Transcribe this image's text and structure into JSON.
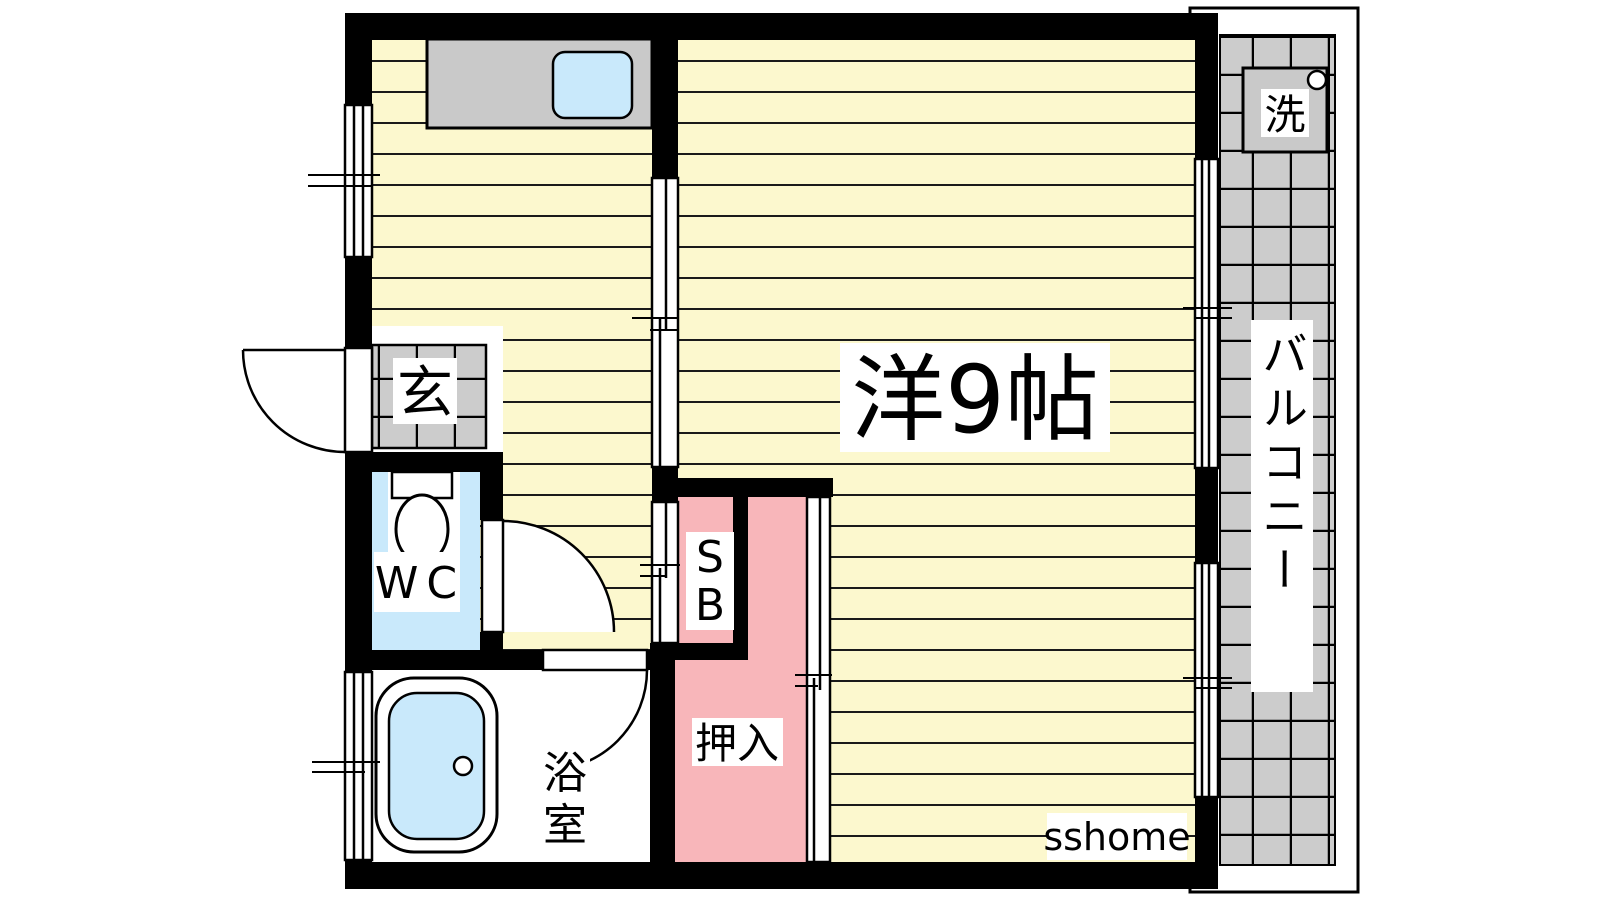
{
  "title": "apartment floor plan",
  "watermark": "sshome",
  "colors": {
    "wall": "#000000",
    "floor_yellow": "#FCF8CE",
    "stripe": "#1A1A1A",
    "closet_pink": "#F8B6BA",
    "water_blue": "#C9E9FB",
    "fixture_gray": "#C9C9C9",
    "tile_gray": "#CCCCCC",
    "label_bg": "#FFFFFF",
    "text": "#000000"
  },
  "rooms": {
    "main_room": {
      "label": "洋9帖"
    },
    "entrance": {
      "label": "玄"
    },
    "toilet": {
      "label": "WC"
    },
    "storage_box": {
      "label": "SB",
      "lines": [
        "S",
        "B"
      ]
    },
    "closet": {
      "label": "押入"
    },
    "bathroom": {
      "label": "浴室",
      "lines": [
        "浴",
        "室"
      ]
    },
    "balcony": {
      "label": "バルコニー"
    },
    "washer": {
      "label": "洗"
    }
  }
}
